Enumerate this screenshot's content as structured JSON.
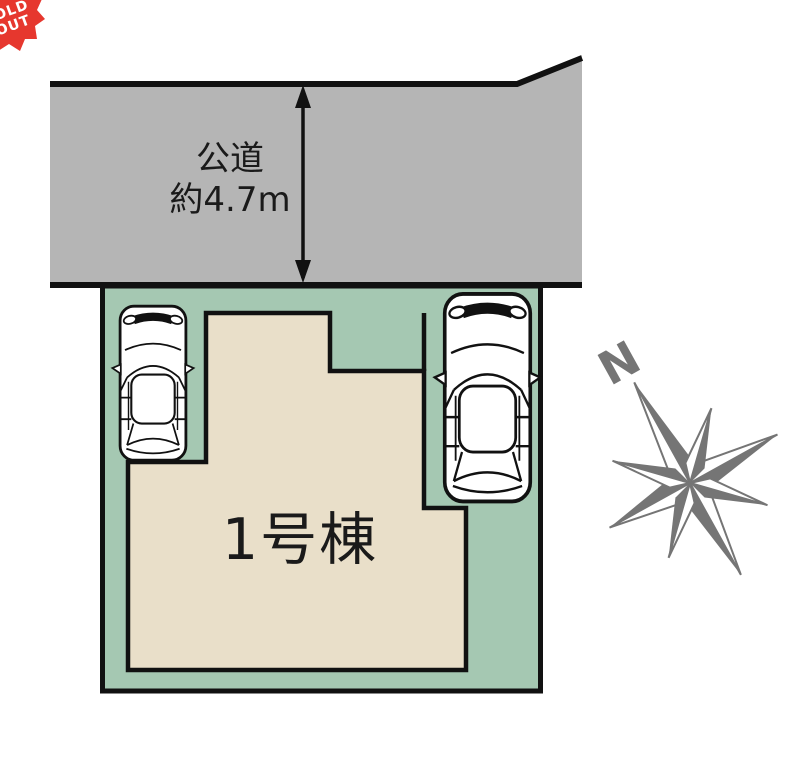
{
  "badge": {
    "line1": "SOLD",
    "line2": "OUT"
  },
  "road": {
    "name_label": "公道",
    "width_label": "約4.7m"
  },
  "building": {
    "label": "1号棟"
  },
  "compass": {
    "north_label": "N"
  },
  "colors": {
    "road": "#b5b5b5",
    "plot_green": "#a5c8b2",
    "building_beige": "#e9dfc9",
    "badge_red": "#e6372e",
    "compass_gray": "#757575",
    "outline": "#111111"
  }
}
